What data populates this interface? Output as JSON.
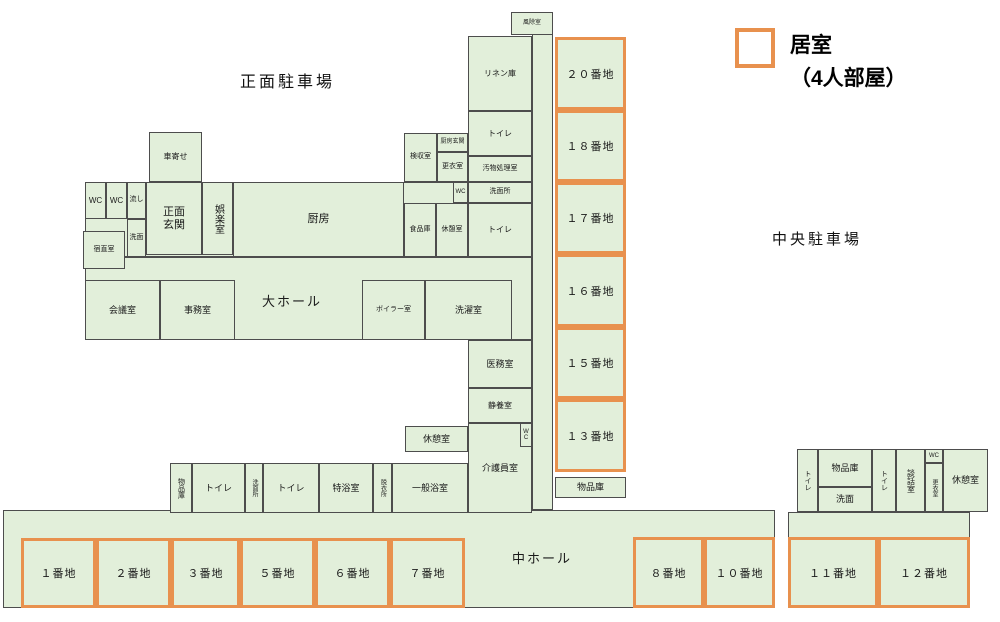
{
  "colors": {
    "room_fill": "#E2EFDA",
    "line": "#4D4D4D",
    "unit_border": "#E8914E"
  },
  "parking": {
    "front": "正面駐車場",
    "central": "中央駐車場"
  },
  "legend": {
    "line1": "居室",
    "line2": "（4人部屋）"
  },
  "halls": {
    "large_hall": "大ホール",
    "middle_hall": "中ホール"
  },
  "rooms": {
    "porch": "車寄せ",
    "wc_a": "WC",
    "wc_b": "WC",
    "nagashi": "流し",
    "senmen_entrance": "洗面",
    "front_entrance": "正面\n玄関",
    "recreation": "娯楽室",
    "kitchen": "厨房",
    "night_duty": "宿直室",
    "inspection": "検収室",
    "kitchen_entrance": "厨房玄関",
    "changing_kitchen": "更衣室",
    "wc_small": "WC",
    "food_storage": "食品庫",
    "break_kitchen": "休憩室",
    "windbreak": "風除室",
    "linen": "リネン庫",
    "toilet_n1": "トイレ",
    "waste": "汚物処理室",
    "washroom_n": "洗面所",
    "toilet_n2": "トイレ",
    "meeting": "会議室",
    "office": "事務室",
    "boiler": "ボイラー室",
    "laundry": "洗濯室",
    "medical": "医務室",
    "rest": "静養室",
    "caregiver": "介護員室",
    "wc_vert": "WC",
    "break_mid": "休憩室",
    "storage_bath": "物品庫",
    "toilet_b1": "トイレ",
    "washroom_bath": "洗面所",
    "toilet_b2": "トイレ",
    "special_bath": "特浴室",
    "undressing": "脱衣所",
    "general_bath": "一般浴室",
    "storage_units": "物品庫",
    "toilet_r1": "トイレ",
    "storage_r": "物品庫",
    "washbasin_r": "洗面",
    "toilet_r2": "トイレ",
    "lounge_r": "談話室",
    "wc_r": "WC",
    "changing_r": "更衣室",
    "break_r": "休憩室"
  },
  "units": {
    "u20": "２０番地",
    "u18": "１８番地",
    "u17": "１７番地",
    "u16": "１６番地",
    "u15": "１５番地",
    "u13": "１３番地",
    "u1": "１番地",
    "u2": "２番地",
    "u3": "３番地",
    "u5": "５番地",
    "u6": "６番地",
    "u7": "７番地",
    "u8": "８番地",
    "u10": "１０番地",
    "u11": "１１番地",
    "u12": "１２番地"
  }
}
